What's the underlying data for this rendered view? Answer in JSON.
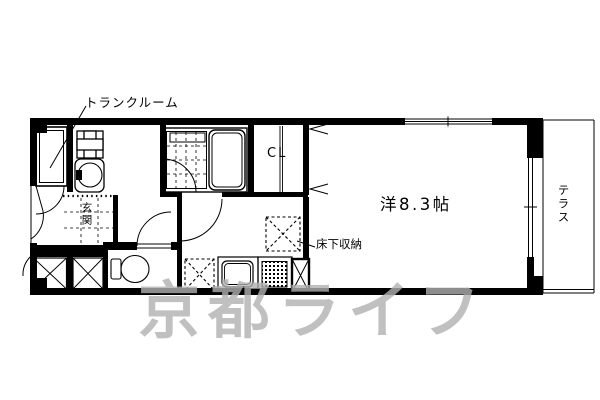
{
  "page": {
    "background": "#ffffff",
    "line_color": "#000000",
    "watermark_color": "rgba(176,176,176,0.8)"
  },
  "floorplan": {
    "type": "apartment-floor-plan",
    "labels": {
      "trunk_room": "トランクルーム",
      "entrance": "玄関",
      "closet": "CL",
      "main_room": "洋8.3帖",
      "underfloor_storage": "床下収納",
      "terrace": "テラス"
    },
    "main_room_size_jo": "8.3",
    "watermark": "京都ライフ"
  }
}
